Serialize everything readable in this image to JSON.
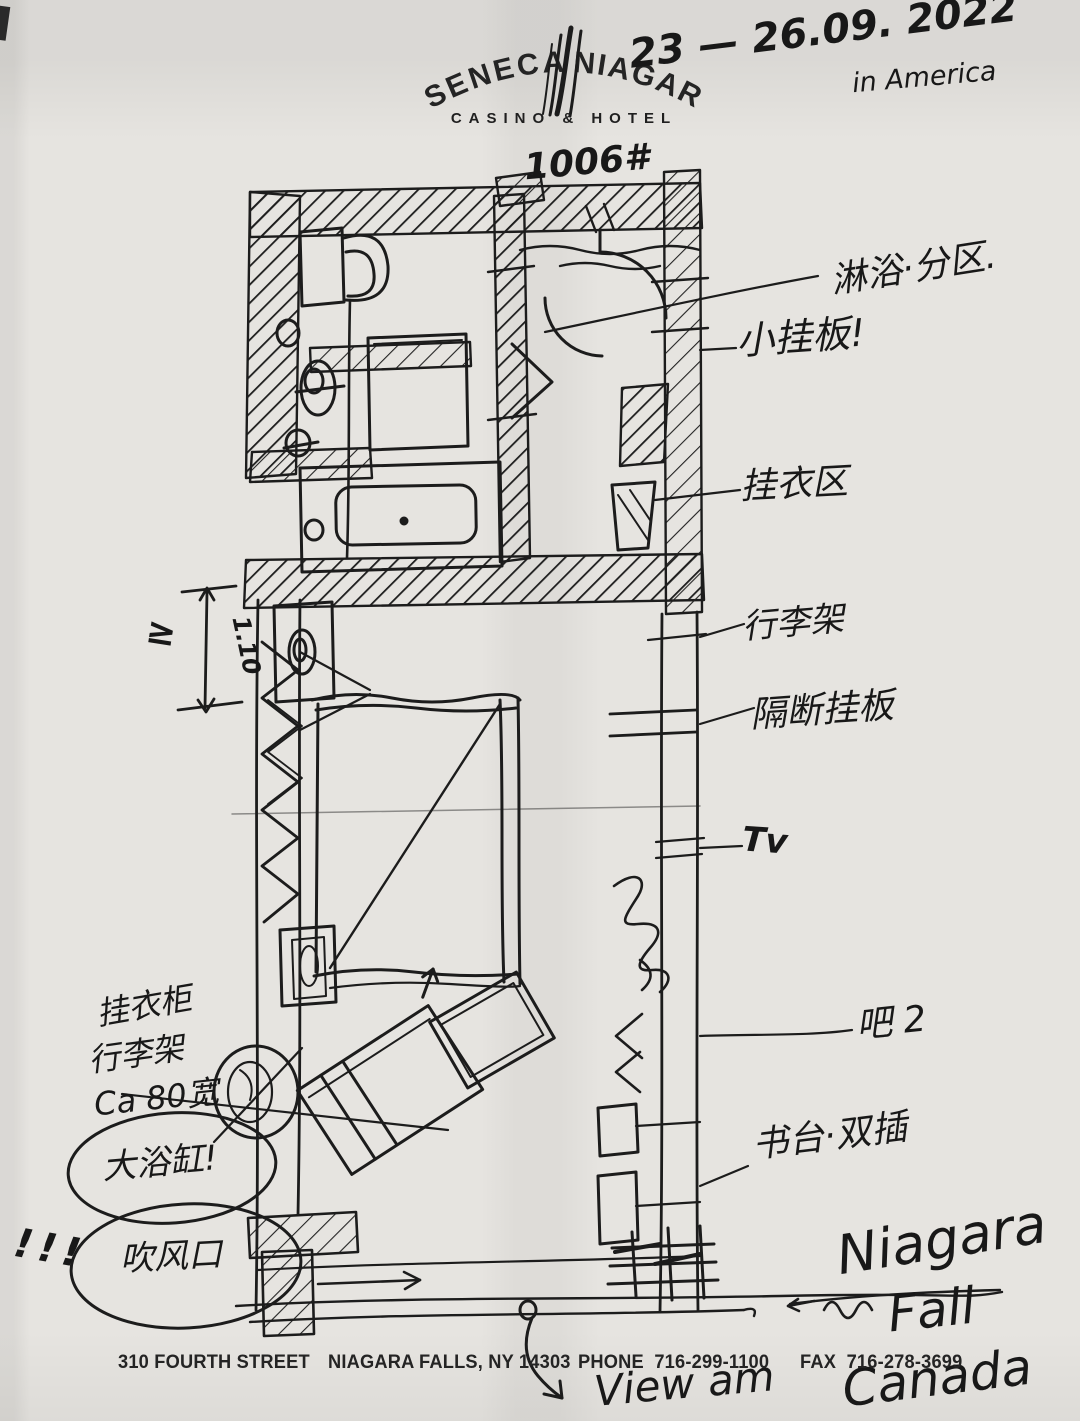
{
  "letterhead": {
    "brand": {
      "left": "SENECA",
      "right": "NIAGARA",
      "tagline": "CASINO & HOTEL"
    },
    "footer": {
      "address": "310 FOURTH STREET",
      "city": "NIAGARA FALLS, NY 14303",
      "phone": "PHONE  716-299-1100",
      "fax": "FAX  716-278-3699"
    }
  },
  "handwriting": {
    "trip_dates": "23 — 26.09. 2022",
    "trip_location": "in America",
    "room_number": "1006#",
    "annotations": {
      "shower_zones": "淋浴·分区.",
      "small_hanging_board": "小挂板!",
      "coat_hanging_area": "挂衣区",
      "luggage_rack": "行李架",
      "partition_board": "隔断挂板",
      "tv": "Tv",
      "bar_counter_2": "吧 2",
      "desk_double_outlet": "书台·双插",
      "min_symbol": "≥",
      "dim_110": "1.10",
      "closet_note": "挂衣柜",
      "luggage_note": "行李架",
      "width_note": "Ca 80宽",
      "big_bathtub": "大浴缸!",
      "blow_vent": "吹风口",
      "exclamations": "!!!",
      "niagara": "Niagara",
      "fall": "Fall",
      "view_am": "View am",
      "canada": "Canada"
    }
  }
}
